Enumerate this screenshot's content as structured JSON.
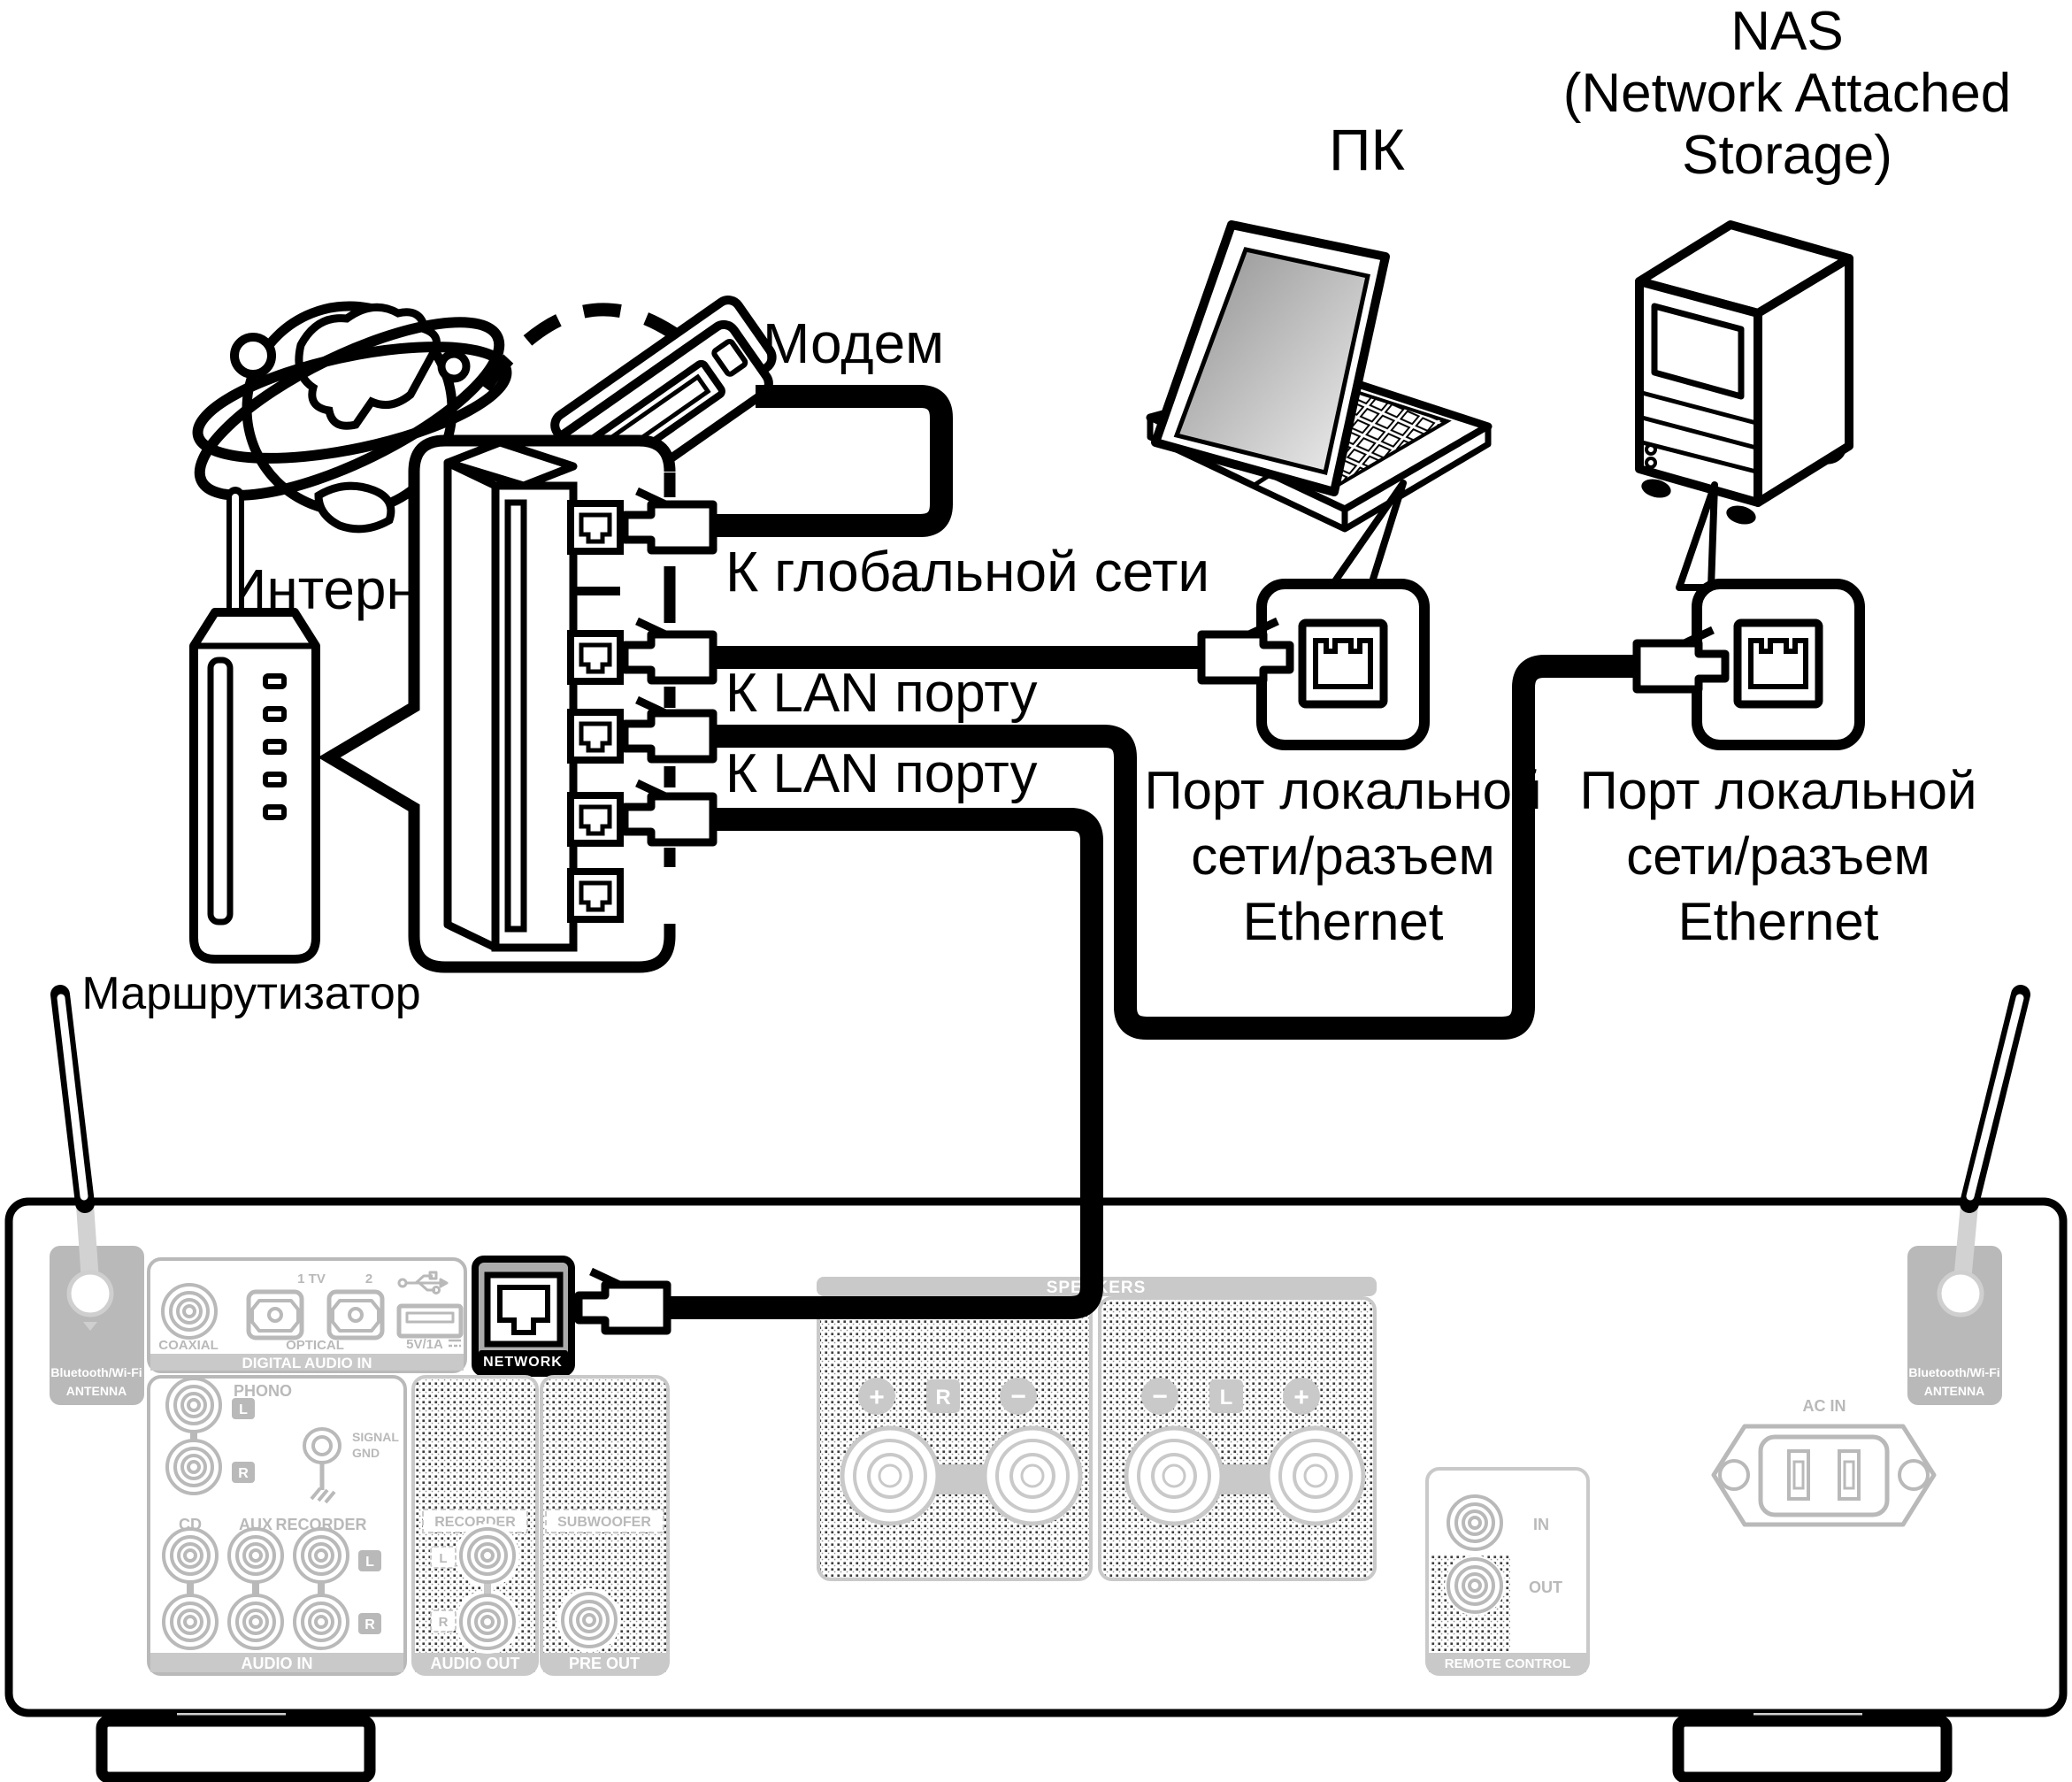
{
  "diagram": {
    "internet": "Интернет",
    "modem": "Модем",
    "router": "Маршрутизатор",
    "to_wan": "К глобальной сети",
    "to_lan_1": "К LAN порту",
    "to_lan_2": "К LAN порту",
    "pc": "ПК",
    "nas_line1": "NAS",
    "nas_line2": "(Network Attached",
    "nas_line3": "Storage)",
    "port_label_line1": "Порт локальной",
    "port_label_line2": "сети/разъем",
    "port_label_line3": "Ethernet"
  },
  "panel": {
    "bt_line1": "Bluetooth/Wi-Fi",
    "bt_line2": "ANTENNA",
    "coaxial": "COAXIAL",
    "optical1": "1 TV",
    "optical2": "2",
    "optical": "OPTICAL",
    "usb": "5V/1A",
    "digital_audio_in": "DIGITAL AUDIO IN",
    "network": "NETWORK",
    "phono": "PHONO",
    "l": "L",
    "r": "R",
    "signal1": "SIGNAL",
    "signal2": "GND",
    "cd": "CD",
    "aux": "AUX",
    "recorder": "RECORDER",
    "audio_in": "AUDIO IN",
    "recorder_out": "RECORDER",
    "audio_out": "AUDIO OUT",
    "subwoofer": "SUBWOOFER",
    "pre_out": "PRE OUT",
    "speakers": "SPEAKERS",
    "plus": "+",
    "minus": "−",
    "in": "IN",
    "out": "OUT",
    "remote": "REMOTE CONTROL",
    "ac_in": "AC IN"
  },
  "colors": {
    "line": "#000000",
    "panel_gray": "#b9b9b9",
    "bar_gray": "#c9c9c9",
    "network_fill": "#ababab"
  }
}
